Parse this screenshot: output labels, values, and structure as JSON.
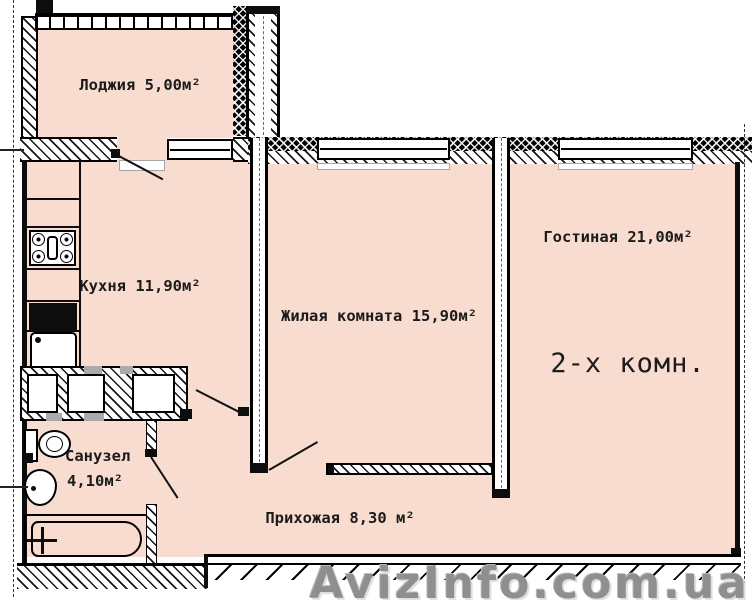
{
  "plan": {
    "type_label": "2-х комн.",
    "rooms": [
      {
        "name": "loggia",
        "label": "Лоджия 5,00м²"
      },
      {
        "name": "kitchen",
        "label": "Кухня 11,90м²"
      },
      {
        "name": "living_room",
        "label": "Жилая комната 15,90м²"
      },
      {
        "name": "lounge",
        "label": "Гостиная 21,00м²"
      },
      {
        "name": "bathroom",
        "label": "Санузел",
        "area_label": "4,10м²"
      },
      {
        "name": "hallway",
        "label": "Прихожая 8,30 м²"
      }
    ],
    "fixtures": [
      "stove",
      "kitchen-sink",
      "toilet",
      "wash-basin",
      "bathtub"
    ],
    "colors": {
      "floor": "#f8dcd0",
      "wall": "#0d0d0d",
      "hatch_bg": "#ffffff",
      "watermark": "#8f8f8f"
    }
  },
  "watermark": {
    "text": "AvizInfo.com.ua"
  }
}
